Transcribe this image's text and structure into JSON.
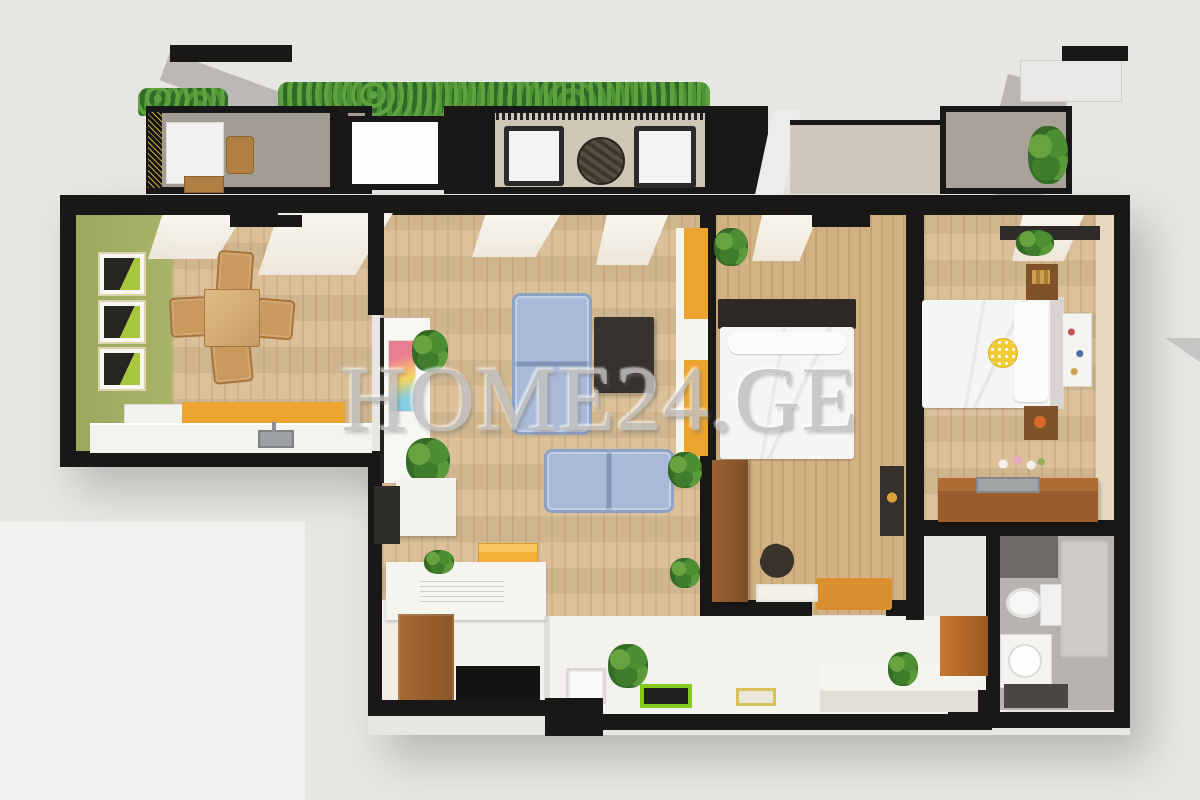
{
  "watermark": {
    "text": "HOME24.GE"
  },
  "scene": {
    "type": "3d-floor-plan-top-view-render",
    "rooms": [
      {
        "name": "terrace-balcony",
        "furniture": [
          "hedge-planters",
          "outdoor-table",
          "outdoor-stools",
          "outdoor-armchairs",
          "round-coffee-table"
        ]
      },
      {
        "name": "kitchen-dining",
        "furniture": [
          "wall-art-frames",
          "dining-table",
          "four-chairs",
          "kitchen-counter",
          "sink",
          "backsplash"
        ]
      },
      {
        "name": "living-room",
        "furniture": [
          "shelf-divider",
          "sofa-vertical",
          "sofa-horizontal",
          "media-panel",
          "yellow-storage-box",
          "desk",
          "plants",
          "yellow-wardrobe"
        ]
      },
      {
        "name": "bedroom-1",
        "furniture": [
          "double-bed",
          "wardrobe",
          "orange-rug",
          "wall-picture",
          "chair"
        ]
      },
      {
        "name": "bedroom-2",
        "furniture": [
          "double-bed",
          "polka-dot-pillow",
          "nightstands",
          "dresser",
          "vanity-with-sink",
          "flowers"
        ]
      },
      {
        "name": "bathroom",
        "furniture": [
          "toilet",
          "washbasin",
          "shower-panel",
          "floor-mat"
        ]
      },
      {
        "name": "hallway",
        "furniture": [
          "doormat",
          "floor-pictures",
          "plants",
          "bench-ledge",
          "cabinet"
        ]
      }
    ]
  },
  "colors": {
    "bg": "#e7e6e3",
    "bg-light": "#f1f1ef",
    "wall": "#191816",
    "wood": "#d9bd95",
    "wood-dark": "#d2b183",
    "green-wall": "#a9b469",
    "hedge": "#2f6b27",
    "hedge-leaf": "#5ea33f",
    "concrete": "#a39c92",
    "terrace": "#d0c6b5",
    "white-floor": "#f4f2ed",
    "counter": "#f5f3ee",
    "orange": "#eca32f",
    "yellow": "#f2b237",
    "sofa": "#a9bad8",
    "sofa-edge": "#8ea2c6",
    "tv": "#36322e",
    "furn-brown": "#8a5527",
    "vanity": "#9a5c2c",
    "rug": "#d98f2e",
    "bath-floor": "#b7b4af",
    "bath-wall": "#6f6b66",
    "watermark": "#c2c1bf"
  }
}
